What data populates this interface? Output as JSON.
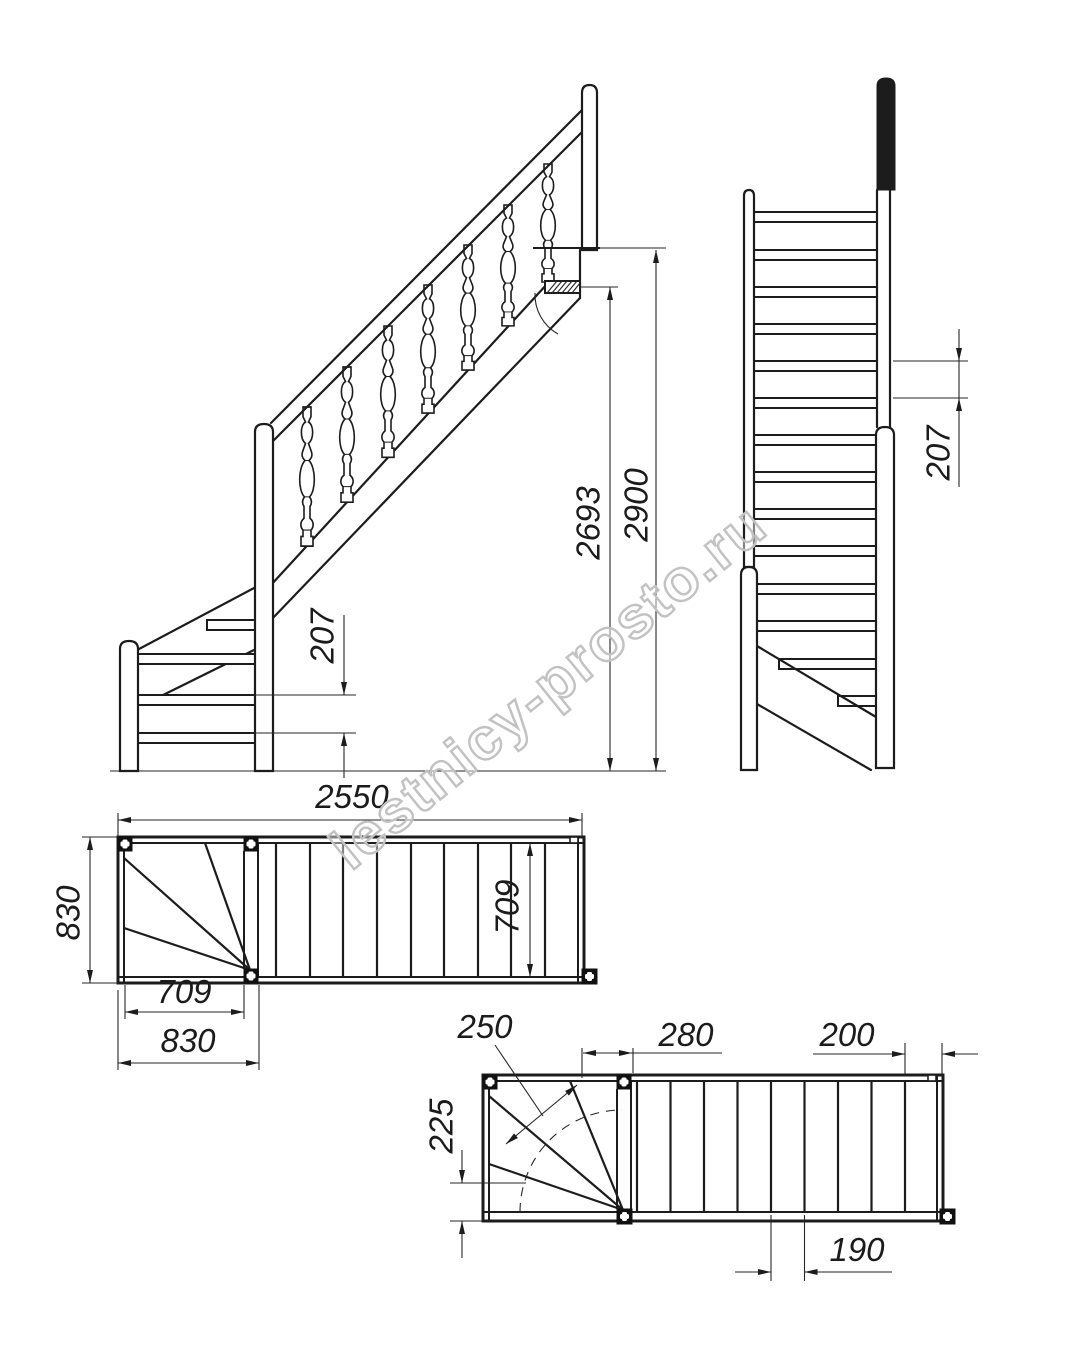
{
  "watermark": {
    "text": "lestnicy-prosto.ru"
  },
  "side_elevation": {
    "dims": {
      "total_height": "2900",
      "height_to_last_tread": "2693",
      "riser": "207"
    }
  },
  "front_view": {
    "dims": {
      "riser": "207"
    }
  },
  "plan_upper": {
    "dims": {
      "total_run": "2550",
      "overall_width": "830",
      "flight_width": "709",
      "winder_width": "709",
      "winder_depth": "830"
    }
  },
  "plan_lower": {
    "dims": {
      "walkline_tread": "250",
      "top_going": "280",
      "landing": "200",
      "winder_side": "225",
      "going": "190"
    }
  }
}
